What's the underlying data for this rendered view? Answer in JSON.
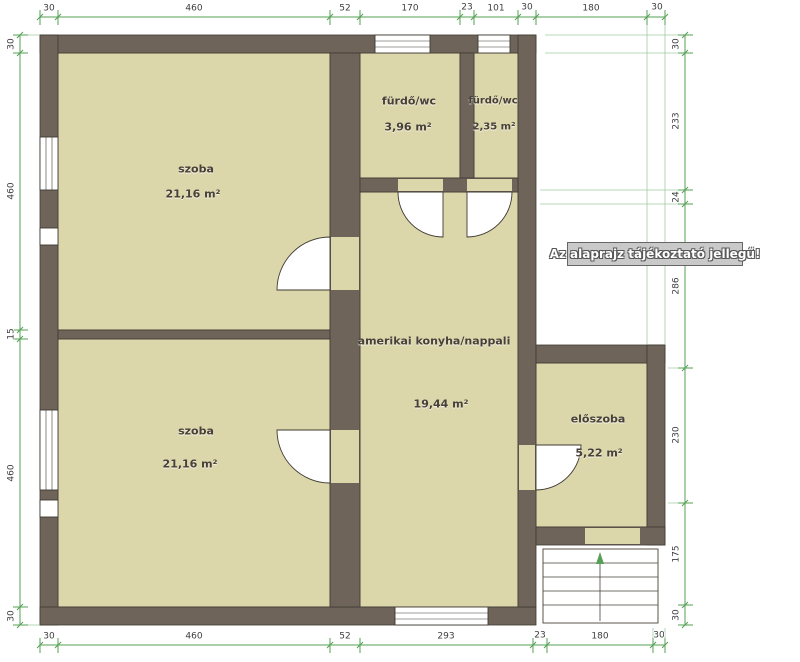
{
  "note": "Az alaprajz tájékoztató jellegű!",
  "unit": "cm",
  "rooms": [
    {
      "id": "szoba-1",
      "name": "szoba",
      "area": "21,16 m²"
    },
    {
      "id": "szoba-2",
      "name": "szoba",
      "area": "21,16 m²"
    },
    {
      "id": "furdo-wc-1",
      "name": "fürdő/wc",
      "area": "3,96 m²"
    },
    {
      "id": "furdo-wc-2",
      "name": "fürdő/wc",
      "area": "2,35 m²"
    },
    {
      "id": "nappali",
      "name": "amerikai konyha/nappali",
      "area": "19,44 m²"
    },
    {
      "id": "eloszoba",
      "name": "előszoba",
      "area": "5,22 m²"
    }
  ],
  "dimensions_cm": {
    "top": [
      "30",
      "460",
      "52",
      "170",
      "23",
      "101",
      "30",
      "180",
      "30"
    ],
    "bottom": [
      "30",
      "460",
      "52",
      "293",
      "23",
      "180",
      "30"
    ],
    "left": [
      "30",
      "460",
      "15",
      "460",
      "30"
    ],
    "right": [
      "30",
      "233",
      "24",
      "286",
      "230",
      "175",
      "30"
    ]
  },
  "dim_labels": [
    {
      "side": "top",
      "i": 0,
      "x": 49,
      "y": 9,
      "r": 0
    },
    {
      "side": "top",
      "i": 1,
      "x": 194,
      "y": 9,
      "r": 0
    },
    {
      "side": "top",
      "i": 2,
      "x": 345,
      "y": 9,
      "r": 0
    },
    {
      "side": "top",
      "i": 3,
      "x": 410,
      "y": 9,
      "r": 0
    },
    {
      "side": "top",
      "i": 4,
      "x": 467,
      "y": 8,
      "r": 0
    },
    {
      "side": "top",
      "i": 5,
      "x": 496,
      "y": 9,
      "r": 0
    },
    {
      "side": "top",
      "i": 6,
      "x": 527,
      "y": 8,
      "r": 0
    },
    {
      "side": "top",
      "i": 7,
      "x": 591,
      "y": 9,
      "r": 0
    },
    {
      "side": "top",
      "i": 8,
      "x": 657,
      "y": 8,
      "r": 0
    },
    {
      "side": "bottom",
      "i": 0,
      "x": 49,
      "y": 637,
      "r": 0
    },
    {
      "side": "bottom",
      "i": 1,
      "x": 194,
      "y": 637,
      "r": 0
    },
    {
      "side": "bottom",
      "i": 2,
      "x": 345,
      "y": 637,
      "r": 0
    },
    {
      "side": "bottom",
      "i": 3,
      "x": 446,
      "y": 637,
      "r": 0
    },
    {
      "side": "bottom",
      "i": 4,
      "x": 540,
      "y": 636,
      "r": 0
    },
    {
      "side": "bottom",
      "i": 5,
      "x": 600,
      "y": 637,
      "r": 0
    },
    {
      "side": "bottom",
      "i": 6,
      "x": 659,
      "y": 636,
      "r": 0
    },
    {
      "side": "left",
      "i": 0,
      "x": 12,
      "y": 44,
      "r": 1
    },
    {
      "side": "left",
      "i": 1,
      "x": 12,
      "y": 191,
      "r": 1
    },
    {
      "side": "left",
      "i": 2,
      "x": 12,
      "y": 334,
      "r": 1
    },
    {
      "side": "left",
      "i": 3,
      "x": 12,
      "y": 473,
      "r": 1
    },
    {
      "side": "left",
      "i": 4,
      "x": 12,
      "y": 616,
      "r": 1
    },
    {
      "side": "right",
      "i": 0,
      "x": 677,
      "y": 44,
      "r": 1
    },
    {
      "side": "right",
      "i": 1,
      "x": 677,
      "y": 121,
      "r": 1
    },
    {
      "side": "right",
      "i": 2,
      "x": 677,
      "y": 197,
      "r": 1
    },
    {
      "side": "right",
      "i": 3,
      "x": 677,
      "y": 286,
      "r": 1
    },
    {
      "side": "right",
      "i": 4,
      "x": 677,
      "y": 435,
      "r": 1
    },
    {
      "side": "right",
      "i": 5,
      "x": 677,
      "y": 554,
      "r": 1
    },
    {
      "side": "right",
      "i": 6,
      "x": 677,
      "y": 615,
      "r": 1
    }
  ],
  "colors": {
    "wall": "#6e6459",
    "floor": "#dcd6ab",
    "dim_line": "#55a055",
    "note_bg": "#c9c9c9"
  }
}
